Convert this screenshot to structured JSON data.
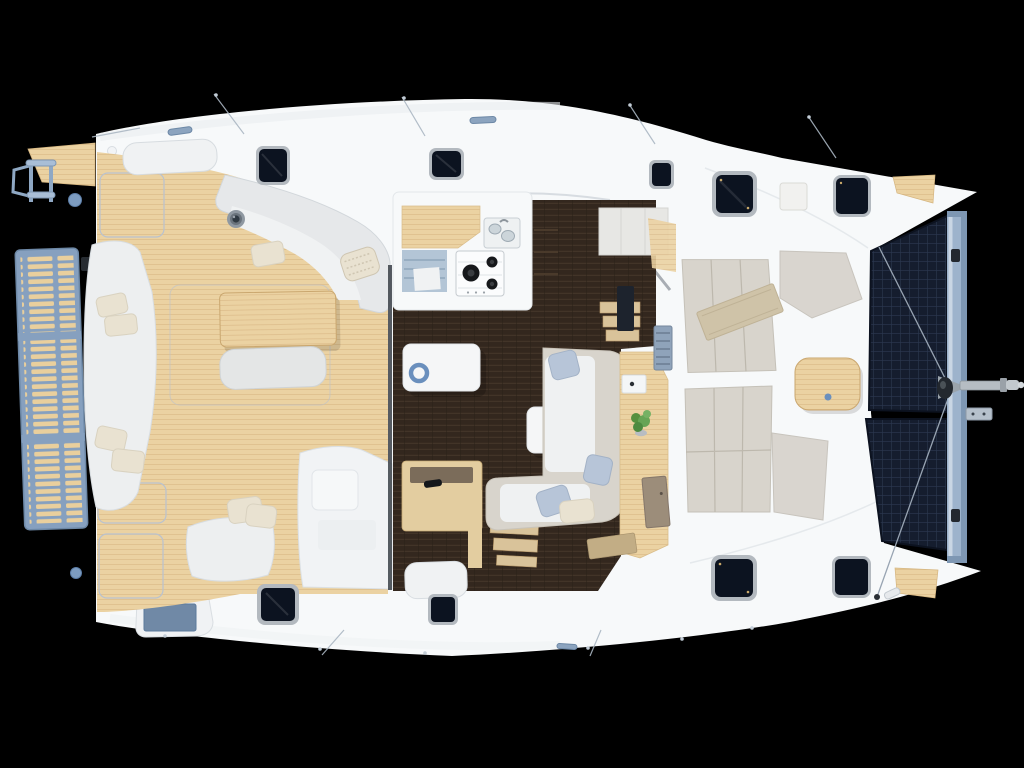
{
  "scene": {
    "description": "Top-down 3D rendered deck plan of a sailing catamaran showing swim platform, aft cockpit, salon with galley, navigation station, forward cockpit and bow trampolines",
    "background": "#000000",
    "canvas_width": "1024",
    "canvas_height": "768"
  },
  "colors": {
    "background": "#000000",
    "hull": "#f7f9fa",
    "hull_shade": "#eef1f3",
    "seam": "#dde3e8",
    "teak": "#ebd2a2",
    "teak_line": "#cfa873",
    "platform_frame": "#86a0bf",
    "platform_slat": "#e9cf9d",
    "ladder_metal": "#a9bed6",
    "trampoline": "#151d2e",
    "trampoline_grid": "#2c3850",
    "crossbeam": "#9db3cc",
    "crossbeam_hi": "#c9d6e4",
    "crossbeam_lo": "#7e97b3",
    "salon_floor": "#33271e",
    "salon_floor_line": "#46372a",
    "hatch_glass": "#0c1320",
    "hatch_frame": "#a6adb4",
    "cushion_grey": "#d8d4cc",
    "cushion_seam": "#bdb8ad",
    "seat_white": "#f0f2f3",
    "cream_pillow": "#e9e2d1",
    "blue_pillow": "#b7c5d8",
    "towel": "#cfc3a8",
    "accent_blue": "#6a8fbd",
    "deck_circle": "#7d9cc0",
    "metal": "#b6bdc3",
    "metal_dark": "#8d959c",
    "plant_green": "#55903f",
    "door_wood": "#9c8d7a",
    "nav_wood": "#e3cda0",
    "nav_inset": "#7b6c5a",
    "stairs_blue": "#b3c5d6",
    "gray_wedge": "#d9d5cf",
    "cabinet_gray": "#e7e7e4",
    "dark_fitting": "#23282f",
    "blue_lid": "#7089a6",
    "windshield": "#9aa0a7"
  },
  "components": {
    "swim_platform": "swim platform with teak slats",
    "swim_ladder": "telescopic swim ladder",
    "aft_cockpit": "aft cockpit with teak sole",
    "cockpit_table": "cockpit teak table",
    "cockpit_settee": "L-shaped cockpit settee",
    "chaise_lounge": "port chaise lounge",
    "corner_settee": "aft corner settee",
    "helm_console": "helm step console",
    "galley": "galley with sink and 3-burner stove",
    "salon_table": "salon coffee table",
    "salon_sofa": "L-shaped salon sofa",
    "nav_station": "navigation desk and seat",
    "companionway_port": "port hull companionway",
    "companionway_stbd_fwd": "starboard forward companionway",
    "companionway_stbd_aft": "starboard aft companionway",
    "forward_cockpit": "forward cockpit sunpads",
    "foredeck_table": "foredeck teak table",
    "trampolines": "bow trampolines",
    "crossbeam": "forward crossbeam",
    "bowsprit": "bowsprit with anchor roller",
    "deck_hatches": "9 flush deck hatches"
  }
}
